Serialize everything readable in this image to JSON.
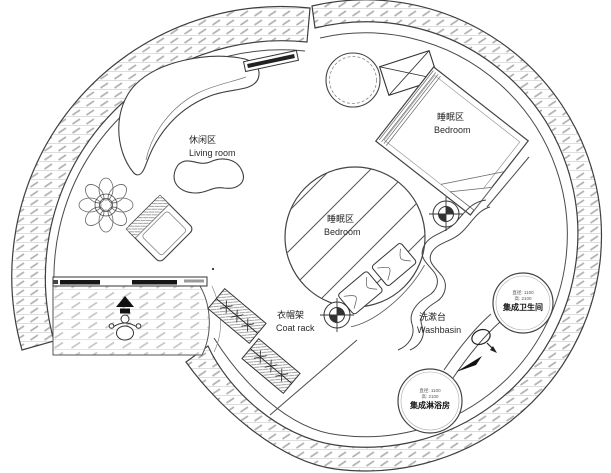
{
  "canvas": {
    "width": 611,
    "height": 473
  },
  "colors": {
    "background": "#ffffff",
    "wall_line": "#3f3f3f",
    "hatch": "#b5b5b5",
    "solid_black": "#151515"
  },
  "labels": {
    "living": {
      "zh": "休闲区",
      "en": "Living room"
    },
    "bedroom_upper": {
      "zh": "睡眠区",
      "en": "Bedroom"
    },
    "bedroom_center": {
      "zh": "睡眠区",
      "en": "Bedroom"
    },
    "coat_rack": {
      "zh": "衣帽架",
      "en": "Coat rack"
    },
    "washbasin": {
      "zh": "洗漱台",
      "en": "Washbasin"
    },
    "bathroom_pod": {
      "dim1": "直径: 1100",
      "dim2": "高: 2100",
      "name": "集成卫生间"
    },
    "shower_pod": {
      "dim1": "直径: 1100",
      "dim2": "高: 2100",
      "name": "集成淋浴房"
    }
  }
}
